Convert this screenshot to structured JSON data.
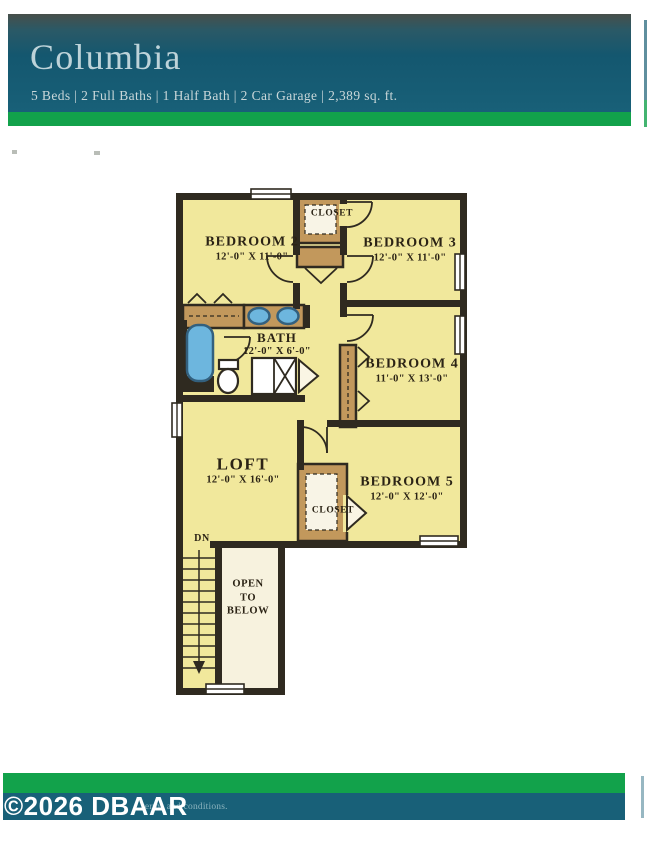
{
  "header": {
    "title": "Columbia",
    "subtitle": "5 Beds | 2 Full Baths | 1 Half Bath | 2 Car Garage | 2,389 sq. ft."
  },
  "floorplan": {
    "rooms": [
      {
        "name": "BEDROOM 2",
        "dims": "12'-0\" X 11'-0\""
      },
      {
        "name": "BEDROOM 3",
        "dims": "12'-0\" X 11'-0\""
      },
      {
        "name": "BEDROOM 4",
        "dims": "11'-0\" X 13'-0\""
      },
      {
        "name": "BEDROOM 5",
        "dims": "12'-0\" X 12'-0\""
      },
      {
        "name": "LOFT",
        "dims": "12'-0\" X 16'-0\""
      },
      {
        "name": "BATH",
        "dims": "12'-0\" X 6'-0\""
      }
    ],
    "annotations": {
      "closet_upper": "CLOSET",
      "closet_lower": "CLOSET",
      "stair_direction": "DN",
      "open_to_below": "OPEN\nTO\nBELOW"
    }
  },
  "footer": {
    "copyright": "©2026 DBAAR",
    "disclaimer_fragment": "terms and conditions."
  },
  "colors": {
    "teal": "#186078",
    "green": "#12a24b",
    "wall": "#2f2a20",
    "room": "#f1e89c",
    "closet": "#c2985c",
    "open_below": "#f7f2de",
    "fixture": "#6db6de",
    "title": "#bdd3d9"
  }
}
